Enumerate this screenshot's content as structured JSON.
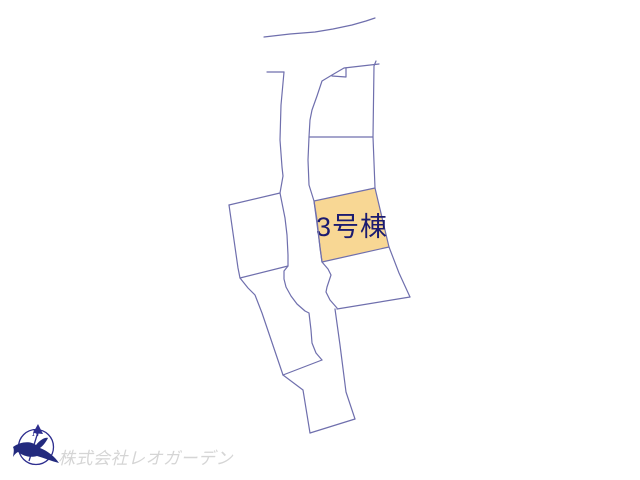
{
  "map": {
    "line_color": "#6f6fad",
    "background_color": "#ffffff",
    "highlighted_parcel": {
      "label": "3号棟",
      "fill": "#f8d794",
      "label_color": "#1b1b70"
    }
  },
  "compass": {
    "north_label": "N",
    "stroke_color": "#2e2e8f",
    "bird_color": "#232a7e"
  },
  "footer": {
    "company": "株式会社レオガーデン",
    "text_color": "#d5d5d5"
  }
}
